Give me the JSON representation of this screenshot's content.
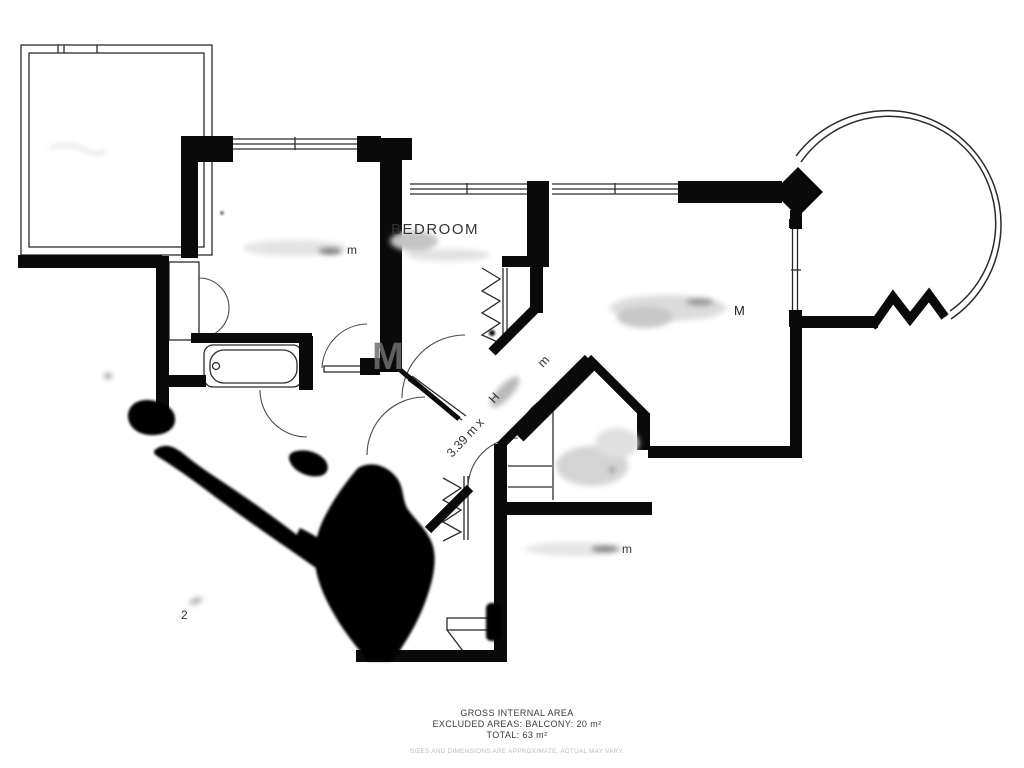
{
  "labels": {
    "bedroom": "BEDROOM",
    "hall_name_remnant": "H",
    "hall_dimension": "3.39 m x",
    "hall_dimension_unit": "m",
    "left_bedroom_remnant": "m",
    "bottom_room_remnant": "m",
    "living_room_remnant": "M",
    "watermark": "M",
    "handwritten_mark": "2"
  },
  "footer": {
    "line1": "GROSS INTERNAL AREA",
    "line2": "EXCLUDED AREAS: BALCONY: 20 m²",
    "line3": "TOTAL: 63 m²",
    "disclaimer": "SIZES AND DIMENSIONS ARE APPROXIMATE, ACTUAL MAY VARY."
  },
  "colors": {
    "wall": "#0a0a0a",
    "line": "#2b2b2b",
    "arc": "#4a4a4a",
    "ink": "#050505",
    "watermark": "#6e6e6e",
    "footer_text": "#3a3a3a",
    "disclaimer_text": "#bdbdbd",
    "label_text": "#333333"
  }
}
